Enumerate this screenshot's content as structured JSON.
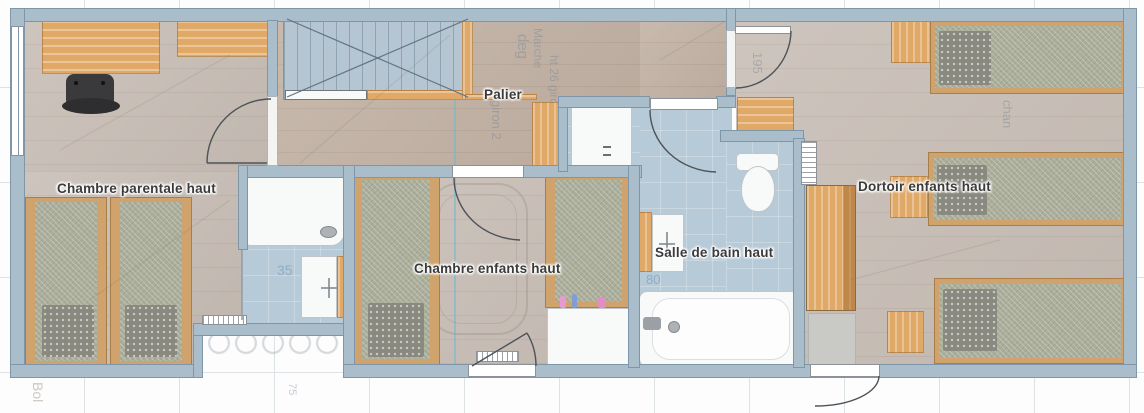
{
  "plan_title": "Floor plan – upper level (étage)",
  "rooms": [
    {
      "id": "chambre-parentale",
      "label": "Chambre parentale haut"
    },
    {
      "id": "palier",
      "label": "Palier"
    },
    {
      "id": "chambre-enfants",
      "label": "Chambre enfants haut"
    },
    {
      "id": "salle-de-bain",
      "label": "Salle de bain haut"
    },
    {
      "id": "dortoir",
      "label": "Dortoir enfants haut"
    }
  ],
  "ghost_annotations": {
    "deg": "deg",
    "marche": "Marche",
    "giron": "ht 26 giron 2",
    "giron2": "giron 2",
    "n195": "195",
    "n35": "35",
    "n80": "80",
    "chan": "chan",
    "bol": "Bol",
    "n75": "75",
    "n450": "450"
  },
  "colors": {
    "wall": "#a9bdcb",
    "wall_edge": "#7e96a7",
    "floor_room": "#c8beb6",
    "floor_landing": "#c2b2a4",
    "floor_bath_tile": "#b7cad7",
    "wood_furniture": "#e1a967",
    "bedding": "#abae9a",
    "pillow": "#8a897f",
    "label_text": "#3b3b3b",
    "teal_guide": "#6eb9cd"
  }
}
